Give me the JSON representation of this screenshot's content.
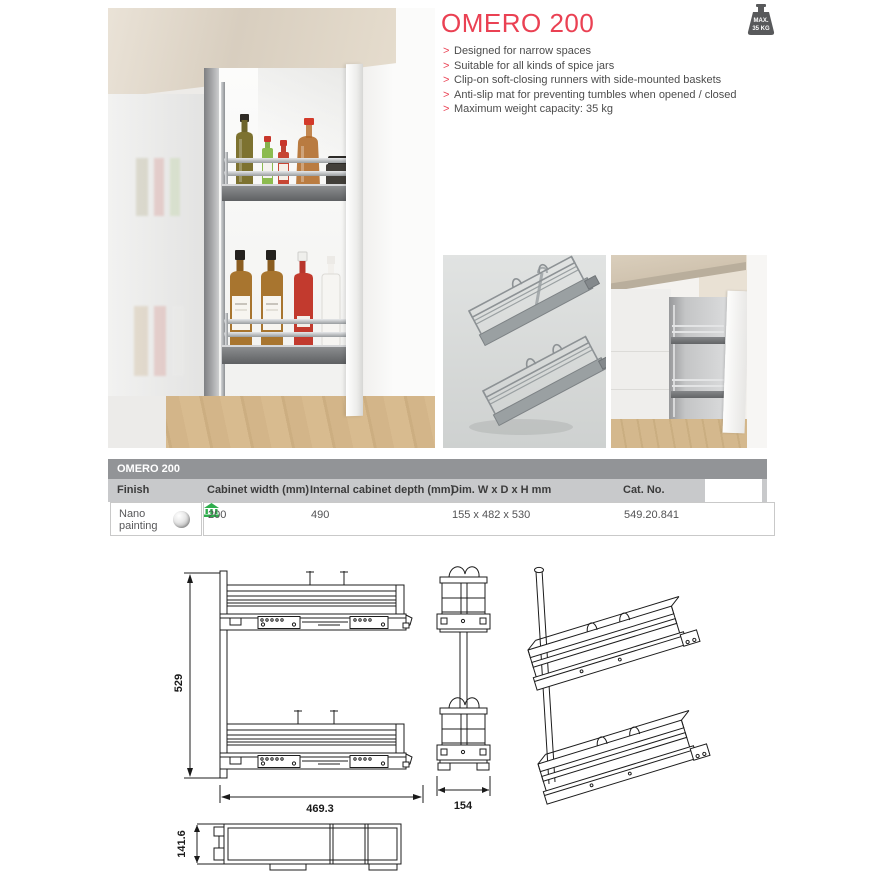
{
  "page": {
    "background": "#ffffff"
  },
  "colors": {
    "accent_red": "#ea4153",
    "table_title_bar": "#929497",
    "table_header_bg": "#c8c9cb",
    "table_border": "#c9c9c9",
    "store_green": "#2fae4d",
    "badge_gray": "#58595b",
    "drawing_stroke": "#1c1c1c"
  },
  "icons": {
    "max_weight": "weight-icon",
    "availability": "store-icon",
    "finish_swatch": "sphere-swatch-icon"
  },
  "product": {
    "title": "OMERO 200",
    "badge": {
      "line1": "MAX.",
      "line2": "35 KG"
    },
    "bullet": ">",
    "features": [
      "Designed for narrow spaces",
      "Suitable for all kinds of spice jars",
      "Clip-on soft-closing runners with side-mounted baskets",
      "Anti-slip mat for preventing tumbles when opened / closed",
      "Maximum weight capacity: 35 kg"
    ]
  },
  "table": {
    "title": "OMERO 200",
    "columns": [
      "Finish",
      "Cabinet width (mm)",
      "Internal cabinet depth (mm)",
      "Dim. W x D x H mm",
      "Cat. No."
    ],
    "rows": [
      {
        "finish": "Nano painting",
        "cabinet_width": "200",
        "internal_depth": "490",
        "dim_wdh": "155 x 482 x 530",
        "cat_no": "549.20.841"
      }
    ]
  },
  "drawings": {
    "side_view": {
      "height": "529",
      "width": "469.3"
    },
    "front_view": {
      "width": "154"
    },
    "top_view": {
      "depth": "141.6"
    }
  }
}
